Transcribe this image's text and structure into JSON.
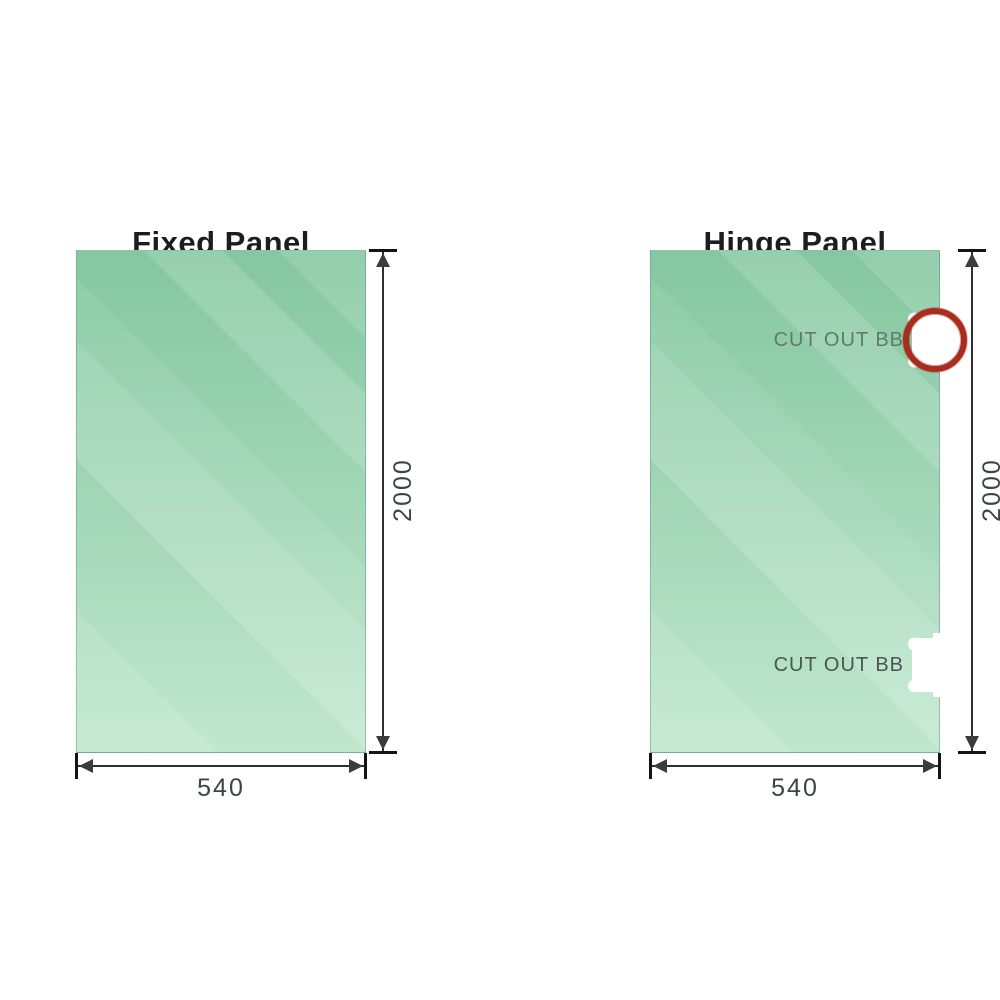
{
  "colors": {
    "background": "#ffffff",
    "glass_green_top": "#84c7a0",
    "glass_green_bottom": "#c0e7ce",
    "dimension_line": "#2f2f2f",
    "dimension_text": "#3e4441",
    "title_text": "#1d1d1d",
    "highlight_ring_red": "#ac2b1e"
  },
  "panels": [
    {
      "title": "Fixed Panel",
      "height_label": "2000",
      "width_label": "540",
      "cutouts": []
    },
    {
      "title": "Hinge Panel",
      "height_label": "2000",
      "width_label": "540",
      "cutouts": [
        {
          "label": "CUT OUT BB",
          "highlighted": true
        },
        {
          "label": "CUT OUT BB",
          "highlighted": false
        }
      ]
    }
  ]
}
